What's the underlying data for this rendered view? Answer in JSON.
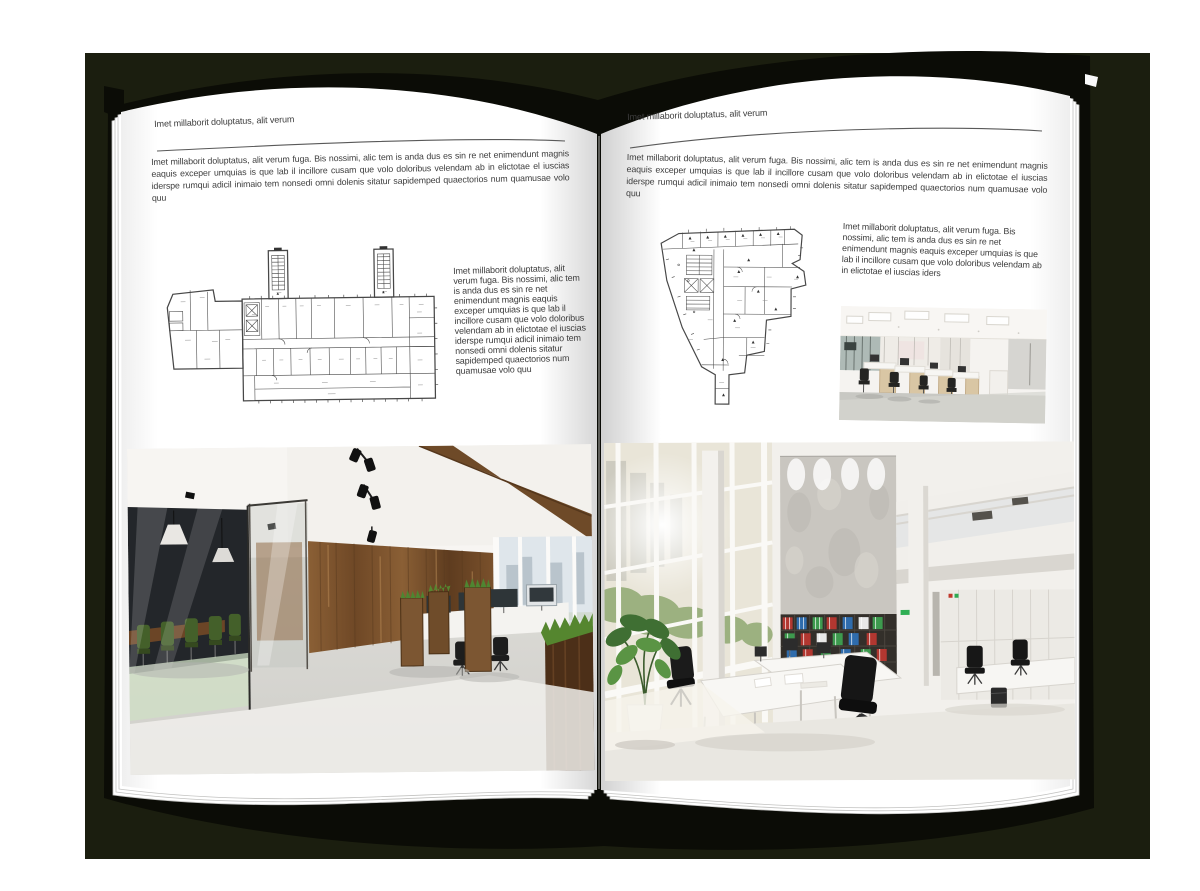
{
  "colors": {
    "backdrop": "#1b1e0f",
    "cover": "#0b0c06",
    "page": "#ffffff",
    "text": "#3c3c3c",
    "rule": "#595959"
  },
  "book": {
    "left": {
      "header": "Imet millaborit doluptatus, alit verum",
      "intro": "Imet millaborit doluptatus, alit verum fuga. Bis nossimi, alic tem is anda dus es sin re net enimendunt magnis eaquis exceper umquias is que lab il incillore cusam que volo doloribus velendam ab in elictotae el iuscias iderspe rumqui adicil inimaio tem nonsedi omni dolenis sitatur sapidemped quaectorios num quamusae volo quu",
      "side_text": "Imet millaborit doluptatus, alit verum fuga. Bis nossimi, alic tem is anda dus es sin re net enimendunt magnis eaquis exceper umquias is que lab il incillore cusam que volo doloribus velendam ab in elictotae el iuscias iderspe rumqui adicil inimaio tem nonsedi omni dolenis sitatur sapidemped quaectorios num quamusae volo quu",
      "figures": {
        "floorplan": "building-floor-plan-drawing",
        "photo": "loft-office-interior-photo"
      }
    },
    "right": {
      "header": "Imet millaborit doluptatus, alit verum",
      "intro": "Imet millaborit doluptatus, alit verum fuga. Bis nossimi, alic tem is anda dus es sin re net enimendunt magnis eaquis exceper umquias is que lab il incillore cusam que volo doloribus velendam ab in elictotae el iuscias iderspe rumqui adicil inimaio tem nonsedi omni dolenis sitatur sapidemped quaectorios num quamusae volo quu",
      "side_text": "Imet millaborit doluptatus, alit verum fuga. Bis nossimi, alic tem is anda dus es sin re net enimendunt magnis eaquis exceper umquias is que lab il incillore cusam que volo doloribus velendam ab in elictotae el iuscias iders",
      "figures": {
        "floorplan": "irregular-building-floor-plan-drawing",
        "photo_small": "cubicle-office-interior-photo",
        "photo_large": "white-atrium-office-interior-photo"
      }
    }
  }
}
